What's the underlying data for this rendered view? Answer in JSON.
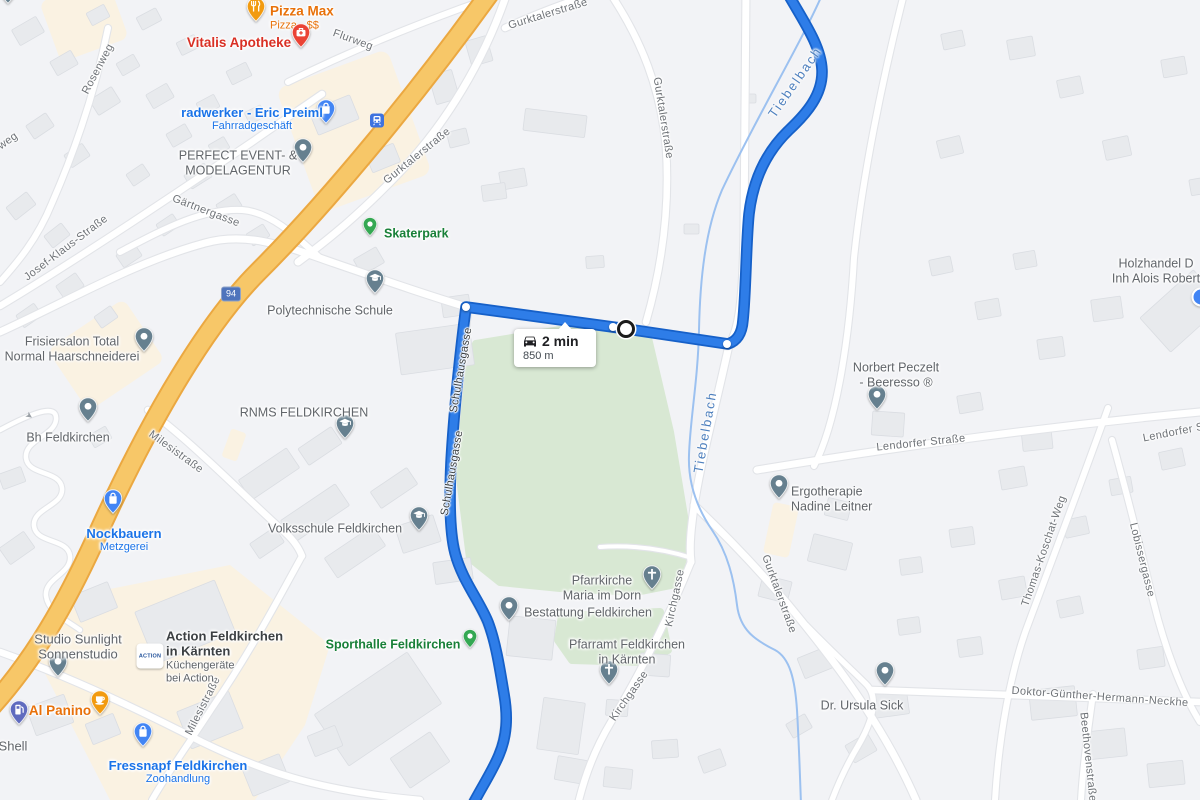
{
  "route": {
    "duration": "2 min",
    "distance": "850 m"
  },
  "shield": {
    "text": "94"
  },
  "map": {
    "water_labels": [
      {
        "t": "Tiebelbach",
        "x": 795,
        "y": 82,
        "r": -55
      },
      {
        "t": "Tiebelbach",
        "x": 705,
        "y": 432,
        "r": -80
      }
    ],
    "street_labels": [
      {
        "t": "weg",
        "x": 8,
        "y": 141,
        "r": -35
      },
      {
        "t": "Rosenweg",
        "x": 98,
        "y": 69,
        "r": -62
      },
      {
        "t": "Flurweg",
        "x": 353,
        "y": 40,
        "r": 20
      },
      {
        "t": "Gurktalerstraße",
        "x": 548,
        "y": 14,
        "r": -17
      },
      {
        "t": "Gurktalerstraße",
        "x": 663,
        "y": 118,
        "r": 81
      },
      {
        "t": "Gurktalerstraße",
        "x": 417,
        "y": 156,
        "r": -39
      },
      {
        "t": "Josef-Klaus-Straße",
        "x": 66,
        "y": 248,
        "r": -37
      },
      {
        "t": "Gärtnergasse",
        "x": 206,
        "y": 211,
        "r": 21
      },
      {
        "t": "Milesistraße",
        "x": 176,
        "y": 452,
        "r": 36
      },
      {
        "t": "Milesistraße",
        "x": 203,
        "y": 706,
        "r": -63
      },
      {
        "t": "Schulhausgasse",
        "x": 461,
        "y": 370,
        "r": -80,
        "k": "onroute"
      },
      {
        "t": "Schulhausgasse",
        "x": 452,
        "y": 473,
        "r": -80,
        "k": "onroute"
      },
      {
        "t": "Kirchgasse",
        "x": 675,
        "y": 598,
        "r": -78
      },
      {
        "t": "Kirchgasse",
        "x": 629,
        "y": 696,
        "r": -55
      },
      {
        "t": "Lendorfer Straße",
        "x": 921,
        "y": 443,
        "r": -6
      },
      {
        "t": "Lendorfer Straße",
        "x": 1187,
        "y": 430,
        "r": -11
      },
      {
        "t": "Thomas-Koschat-Weg",
        "x": 1044,
        "y": 551,
        "r": -71
      },
      {
        "t": "Lobissergasse",
        "x": 1142,
        "y": 560,
        "r": 76
      },
      {
        "t": "Doktor-Günther-Hermann-Neckhe",
        "x": 1100,
        "y": 697,
        "r": 4
      },
      {
        "t": "Beethovenstraße",
        "x": 1088,
        "y": 757,
        "r": 84
      },
      {
        "t": "Gurktalerstraße",
        "x": 779,
        "y": 594,
        "r": 70
      }
    ],
    "pois": [
      {
        "id": "clipped-pin",
        "pin": {
          "x": 8,
          "y": -6,
          "icon": "dot",
          "color": "#66808F"
        }
      },
      {
        "id": "pizza-max",
        "lines": [
          "Pizza Max"
        ],
        "sub": [
          "Pizza · $$"
        ],
        "color": "orange",
        "pin": {
          "x": 256,
          "y": 12,
          "icon": "restaurant",
          "color": "#F29B11"
        },
        "label": {
          "x": 270,
          "y": 18,
          "align": "left"
        },
        "size": 13.5
      },
      {
        "id": "vitalis-apotheke",
        "lines": [
          "Vitalis Apotheke"
        ],
        "color": "red",
        "pin": {
          "x": 301,
          "y": 38,
          "icon": "med",
          "color": "#EA4335"
        },
        "label": {
          "x": 239,
          "y": 43
        },
        "size": 13.5
      },
      {
        "id": "radwerker",
        "lines": [
          "radwerker - Eric Preiml"
        ],
        "sub": [
          "Fahrradgeschäft"
        ],
        "color": "blue",
        "pin": {
          "x": 326,
          "y": 114,
          "icon": "bag",
          "color": "#4285F4"
        },
        "label": {
          "x": 252,
          "y": 119
        },
        "size": 13
      },
      {
        "id": "perfect-event",
        "lines": [
          "PERFECT EVENT- &",
          "MODELAGENTUR"
        ],
        "color": "grey",
        "pin": {
          "x": 303,
          "y": 153,
          "icon": "dot",
          "color": "#66808F"
        },
        "label": {
          "x": 238,
          "y": 163
        }
      },
      {
        "id": "skaterpark",
        "lines": [
          "Skaterpark"
        ],
        "color": "green",
        "pin": {
          "x": 370,
          "y": 229,
          "icon": "dot",
          "color": "#34A853",
          "small": true
        },
        "label": {
          "x": 384,
          "y": 234,
          "align": "left"
        }
      },
      {
        "id": "polytechnische-schule",
        "lines": [
          "Polytechnische Schule"
        ],
        "color": "grey",
        "pin": {
          "x": 375,
          "y": 284,
          "icon": "school",
          "color": "#66808F"
        },
        "label": {
          "x": 330,
          "y": 311
        }
      },
      {
        "id": "frisiersalon",
        "lines": [
          "Frisiersalon Total",
          "Normal Haarschneiderei"
        ],
        "color": "grey",
        "pin": {
          "x": 144,
          "y": 342,
          "icon": "dot",
          "color": "#66808F"
        },
        "label": {
          "x": 72,
          "y": 349
        }
      },
      {
        "id": "bh-feldkirchen",
        "lines": [
          "Bh Feldkirchen"
        ],
        "color": "grey",
        "pin": {
          "x": 88,
          "y": 412,
          "icon": "dot",
          "color": "#66808F"
        },
        "label": {
          "x": 68,
          "y": 438
        }
      },
      {
        "id": "rnms-feldkirchen",
        "lines": [
          "RNMS FELDKIRCHEN"
        ],
        "color": "grey",
        "pin": {
          "x": 345,
          "y": 429,
          "icon": "school",
          "color": "#66808F"
        },
        "label": {
          "x": 304,
          "y": 413
        }
      },
      {
        "id": "volksschule-feldkirchen",
        "lines": [
          "Volksschule Feldkirchen"
        ],
        "color": "grey",
        "pin": {
          "x": 419,
          "y": 521,
          "icon": "school",
          "color": "#66808F"
        },
        "label": {
          "x": 335,
          "y": 529
        }
      },
      {
        "id": "nockbauern",
        "lines": [
          "Nockbauern"
        ],
        "sub": [
          "Metzgerei"
        ],
        "color": "blue",
        "pin": {
          "x": 113,
          "y": 504,
          "icon": "bag",
          "color": "#4285F4"
        },
        "label": {
          "x": 124,
          "y": 540
        },
        "size": 13
      },
      {
        "id": "studio-sunlight",
        "lines": [
          "Studio Sunlight",
          "Sonnenstudio"
        ],
        "color": "grey",
        "pin": {
          "x": 58,
          "y": 667,
          "icon": "dot",
          "color": "#66808F"
        },
        "label": {
          "x": 78,
          "y": 647
        },
        "size": 13
      },
      {
        "id": "action-feldkirchen",
        "lines": [
          "Action Feldkirchen",
          "in Kärnten"
        ],
        "sub": [
          "Küchengeräte",
          "bei Action"
        ],
        "color": "dark",
        "logo": {
          "x": 150,
          "y": 656,
          "text": "ACTION"
        },
        "label": {
          "x": 166,
          "y": 657,
          "align": "left"
        },
        "size": 13
      },
      {
        "id": "al-panino",
        "lines": [
          "Al Panino"
        ],
        "color": "orange",
        "pin": {
          "x": 100,
          "y": 705,
          "icon": "cup",
          "color": "#F29B11"
        },
        "label": {
          "x": 60,
          "y": 711
        },
        "size": 13.5
      },
      {
        "id": "shell",
        "lines": [
          "Shell"
        ],
        "color": "grey",
        "pin": {
          "x": 19,
          "y": 715,
          "icon": "fuel",
          "color": "#5F6BBF"
        },
        "label": {
          "x": 13,
          "y": 746
        },
        "size": 13
      },
      {
        "id": "fressnapf",
        "lines": [
          "Fressnapf Feldkirchen"
        ],
        "sub": [
          "Zoohandlung"
        ],
        "color": "blue",
        "pin": {
          "x": 143,
          "y": 737,
          "icon": "bag",
          "color": "#4285F4"
        },
        "label": {
          "x": 178,
          "y": 772
        },
        "size": 13
      },
      {
        "id": "sporthalle-feldkirchen",
        "lines": [
          "Sporthalle Feldkirchen"
        ],
        "color": "green",
        "pin": {
          "x": 470,
          "y": 641,
          "icon": "dot",
          "color": "#34A853",
          "small": true
        },
        "label": {
          "x": 393,
          "y": 645
        }
      },
      {
        "id": "pfarrkirche",
        "lines": [
          "Pfarrkirche",
          "Maria im Dorn"
        ],
        "color": "grey",
        "pin": {
          "x": 652,
          "y": 580,
          "icon": "church",
          "color": "#66808F"
        },
        "label": {
          "x": 602,
          "y": 588
        }
      },
      {
        "id": "bestattung",
        "lines": [
          "Bestattung Feldkirchen"
        ],
        "color": "grey",
        "pin": {
          "x": 509,
          "y": 611,
          "icon": "dot",
          "color": "#66808F"
        },
        "label": {
          "x": 588,
          "y": 613
        }
      },
      {
        "id": "pfarramt",
        "lines": [
          "Pfarramt Feldkirchen",
          "in Kärnten"
        ],
        "color": "grey",
        "pin": {
          "x": 609,
          "y": 675,
          "icon": "church",
          "color": "#66808F"
        },
        "label": {
          "x": 627,
          "y": 652
        }
      },
      {
        "id": "norbert-peczelt",
        "lines": [
          "Norbert Peczelt",
          "- Beeresso ®"
        ],
        "color": "grey",
        "pin": {
          "x": 877,
          "y": 400,
          "icon": "dot",
          "color": "#66808F"
        },
        "label": {
          "x": 896,
          "y": 375
        }
      },
      {
        "id": "ergotherapie",
        "lines": [
          "Ergotherapie",
          "Nadine Leitner"
        ],
        "color": "grey",
        "pin": {
          "x": 779,
          "y": 489,
          "icon": "dot",
          "color": "#66808F"
        },
        "label": {
          "x": 791,
          "y": 499,
          "align": "left"
        }
      },
      {
        "id": "dr-ursula-sick",
        "lines": [
          "Dr. Ursula Sick"
        ],
        "color": "grey",
        "pin": {
          "x": 885,
          "y": 676,
          "icon": "dot",
          "color": "#66808F"
        },
        "label": {
          "x": 862,
          "y": 706
        }
      },
      {
        "id": "holzhandel",
        "lines": [
          "Holzhandel D",
          "Inh Alois Robert"
        ],
        "color": "grey",
        "label": {
          "x": 1156,
          "y": 271
        }
      }
    ]
  },
  "colors": {
    "land": "#F2F3F6",
    "building": "#E8EAED",
    "park": "#D8E8D3",
    "beige": "#FAF2E2",
    "road": "#FFFFFF",
    "road_casing": "#E2E4E8",
    "highway": "#F7C768",
    "highway_casing": "#EBA841",
    "route": "#2E7DE8",
    "route_casing": "#1660C8",
    "stream": "#9CC1F0"
  }
}
